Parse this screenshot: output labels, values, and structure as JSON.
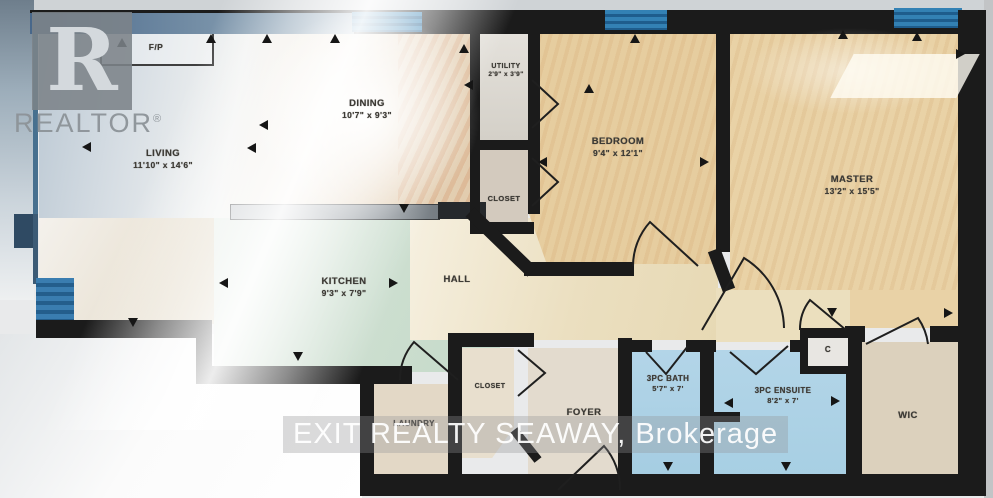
{
  "rooms": {
    "living": {
      "name": "LIVING",
      "dims": "11'10\" x 14'6\""
    },
    "dining": {
      "name": "DINING",
      "dims": "10'7\" x 9'3\""
    },
    "kitchen": {
      "name": "KITCHEN",
      "dims": "9'3\" x 7'9\""
    },
    "hall": {
      "name": "HALL",
      "dims": ""
    },
    "utility": {
      "name": "UTILITY",
      "dims": "2'9\" x 3'9\""
    },
    "bedroom_closet": {
      "name": "CLOSET",
      "dims": ""
    },
    "bedroom": {
      "name": "BEDROOM",
      "dims": "9'4\" x 12'1\""
    },
    "master": {
      "name": "MASTER",
      "dims": "13'2\" x 15'5\""
    },
    "laundry": {
      "name": "LAUNDRY",
      "dims": ""
    },
    "foyer_closet": {
      "name": "CLOSET",
      "dims": ""
    },
    "foyer": {
      "name": "FOYER",
      "dims": ""
    },
    "bath": {
      "name": "3PC BATH",
      "dims": "5'7\" x 7'"
    },
    "ensuite": {
      "name": "3PC ENSUITE",
      "dims": "8'2\" x 7'"
    },
    "wic": {
      "name": "WIC",
      "dims": ""
    },
    "hall_closet": {
      "name": "C",
      "dims": ""
    },
    "fireplace": {
      "name": "F/P",
      "dims": ""
    }
  },
  "watermarks": {
    "realtor_letter": "R",
    "realtor_name": "REALTOR",
    "registered_symbol": "®",
    "brokerage_line": "EXIT REALTY SEAWAY, Brokerage"
  },
  "colors": {
    "wall": "#1b1b1b",
    "window_blue": "#2e7cb0",
    "kitchen_floor": "#cfe0d3",
    "bath_floor": "#a9cfe4",
    "bedroom_floor": "#e7cfa3",
    "hall_floor": "#ece1c6",
    "foyer_floor": "#e4dbcb"
  }
}
